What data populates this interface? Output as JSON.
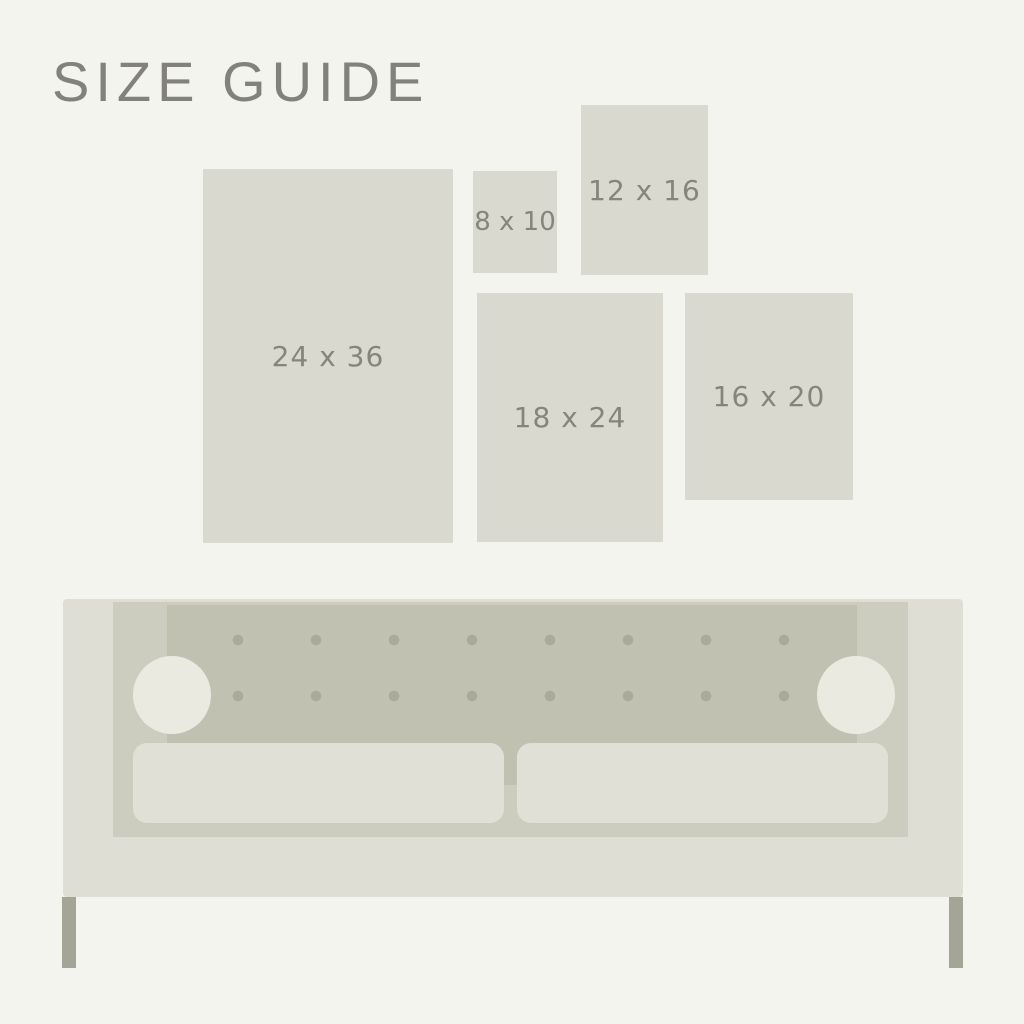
{
  "page": {
    "title": "SIZE GUIDE"
  },
  "size_guide": {
    "sizes": [
      {
        "id": "24x36",
        "label": "24 x 36"
      },
      {
        "id": "8x10",
        "label": "8 x 10"
      },
      {
        "id": "12x16",
        "label": "12 x 16"
      },
      {
        "id": "18x24",
        "label": "18 x 24"
      },
      {
        "id": "16x20",
        "label": "16 x 20"
      }
    ]
  },
  "illustration": {
    "name": "sofa",
    "tufting_buttons_per_row": 8,
    "tufting_rows": 2,
    "seat_cushions": 2,
    "bolster_pillows": 2,
    "legs": 2
  },
  "colors": {
    "background": "#F4F4EF",
    "title_text": "#82827A",
    "size_rect_fill": "#D9D9D0",
    "size_label_text": "#85857B",
    "sofa_frame": "#DEDED4",
    "sofa_seat_base": "#CCCCBF",
    "sofa_back_panel": "#C1C1B2",
    "tufting_dot": "#A9A99C",
    "bolster_pillow": "#EAEAE1",
    "seat_cushion": "#E0E0D7",
    "sofa_leg": "#A4A497"
  }
}
